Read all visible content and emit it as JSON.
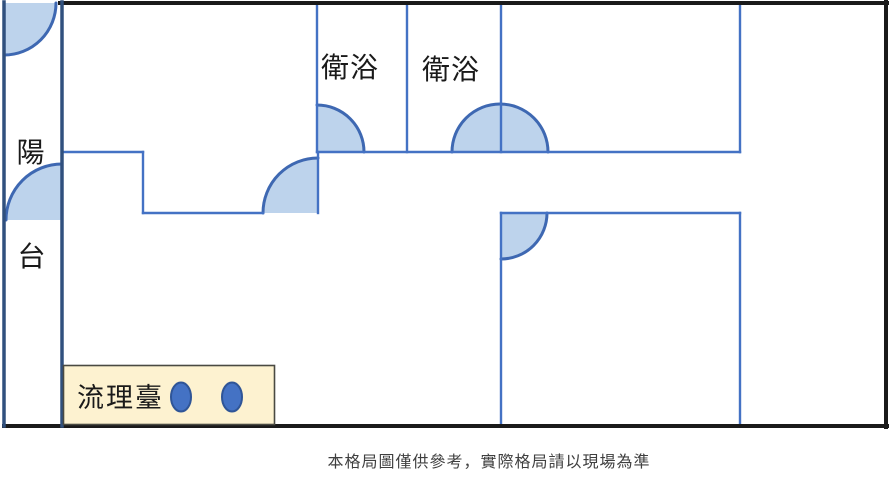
{
  "floor_plan": {
    "balcony": {
      "label_char_top": "陽",
      "label_char_bottom": "台"
    },
    "bathroom1": {
      "label": "衛浴"
    },
    "bathroom2": {
      "label": "衛浴"
    },
    "kitchen_counter": {
      "label": "流理臺",
      "basin_count": 2
    },
    "door_swings": [
      "balcony-top-door",
      "balcony-middle-door",
      "living-room-door",
      "bathroom1-door",
      "bathroom2-double-door",
      "bottom-right-bedroom-door"
    ]
  },
  "footer": {
    "disclaimer": "本格局圖僅供參考，實際格局請以現場為準"
  },
  "colors": {
    "outer_wall": "#1a1a1a",
    "balcony_wall": "#30507e",
    "interior_wall": "#4472c4",
    "door_arc_stroke": "#3e68b2",
    "door_arc_fill": "#bdd3ec",
    "counter_fill": "#fdf2d0",
    "counter_border": "#4a4a42",
    "sink_fill": "#4472c4",
    "sink_stroke": "#2f5597",
    "label_color": "#1a1a1a",
    "disclaimer_color": "#3f3f3f"
  }
}
